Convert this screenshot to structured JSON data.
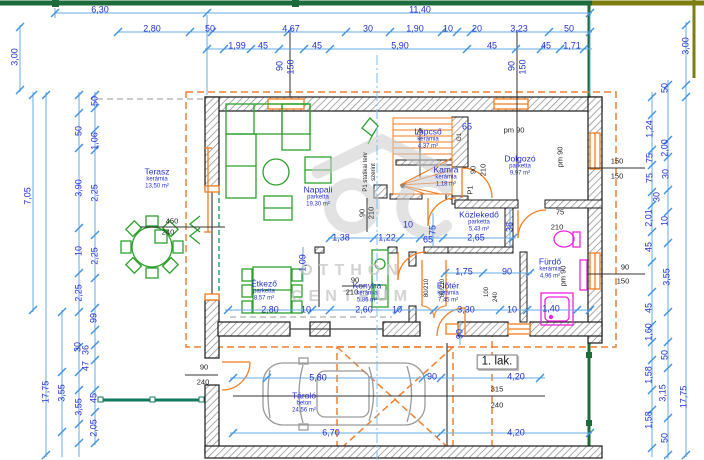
{
  "watermark": {
    "line1": "OTTHON",
    "line2": "CENTRUM"
  },
  "colors": {
    "dimension_blue": "#2531cf",
    "dim_line_blue": "#66abe9",
    "wall_black": "#1a1a1a",
    "door_orange": "#f07d21",
    "furniture_green": "#2ca02c",
    "fixture_magenta": "#ee22dd",
    "boundary_green": "#1c6b3a",
    "boundary_olive": "#7e7e10",
    "fence_teal": "#11795e",
    "watermark_gray": "#c7c7c7",
    "car_gray": "#9a9a9a"
  },
  "plan": {
    "unit_label": "1. lak.",
    "rooms": [
      {
        "name": "Terasz",
        "material": "kerámia",
        "area": "13,50 m²",
        "x": 157,
        "y": 179
      },
      {
        "name": "Nappali",
        "material": "parketta",
        "area": "19,30 m²",
        "x": 318,
        "y": 197
      },
      {
        "name": "Lépcső",
        "material": "kerámia",
        "area": "4,37 m²",
        "x": 428,
        "y": 139
      },
      {
        "name": "Kamra",
        "material": "kerámia",
        "area": "1,18 m²",
        "x": 446,
        "y": 177
      },
      {
        "name": "Dolgozó",
        "material": "parketta",
        "area": "9,97 m²",
        "x": 520,
        "y": 166
      },
      {
        "name": "Közlekedő",
        "material": "parketta",
        "area": "5,43 m²",
        "x": 479,
        "y": 222
      },
      {
        "name": "Fürdő",
        "material": "kerámia",
        "area": "4,96 m²",
        "x": 550,
        "y": 269
      },
      {
        "name": "Előtér",
        "material": "kerámia",
        "area": "7,45 m²",
        "x": 448,
        "y": 293
      },
      {
        "name": "Konyha",
        "material": "kerámia",
        "area": "5,86 m²",
        "x": 367,
        "y": 293
      },
      {
        "name": "Étkező",
        "material": "parketta",
        "area": "8,57 m²",
        "x": 264,
        "y": 291
      },
      {
        "name": "Tároló",
        "material": "beton",
        "area": "24,56 m²",
        "x": 304,
        "y": 403
      }
    ],
    "labels": [
      {
        "t": "6,30",
        "x": 100,
        "y": 10
      },
      {
        "t": "11,40",
        "x": 420,
        "y": 10
      },
      {
        "t": "2,80",
        "x": 152,
        "y": 29
      },
      {
        "t": "50",
        "x": 210,
        "y": 29
      },
      {
        "t": "4,67",
        "x": 291,
        "y": 29
      },
      {
        "t": "30",
        "x": 368,
        "y": 29
      },
      {
        "t": "1,90",
        "x": 415,
        "y": 29
      },
      {
        "t": "10",
        "x": 448,
        "y": 29
      },
      {
        "t": "20",
        "x": 477,
        "y": 29
      },
      {
        "t": "3,23",
        "x": 519,
        "y": 29
      },
      {
        "t": "50",
        "x": 569,
        "y": 29
      },
      {
        "t": "1,99",
        "x": 237,
        "y": 46
      },
      {
        "t": "45",
        "x": 263,
        "y": 46
      },
      {
        "t": "45",
        "x": 317,
        "y": 46
      },
      {
        "t": "5,90",
        "x": 400,
        "y": 46
      },
      {
        "t": "45",
        "x": 492,
        "y": 46
      },
      {
        "t": "45",
        "x": 546,
        "y": 46
      },
      {
        "t": "1,71",
        "x": 572,
        "y": 46
      },
      {
        "t": "90",
        "x": 280,
        "y": 66,
        "r": 1
      },
      {
        "t": "150",
        "x": 291,
        "y": 67,
        "r": 1
      },
      {
        "t": "90",
        "x": 512,
        "y": 66,
        "r": 1
      },
      {
        "t": "150",
        "x": 523,
        "y": 67,
        "r": 1
      },
      {
        "t": "3,00",
        "x": 15,
        "y": 57,
        "r": 1
      },
      {
        "t": "7,05",
        "x": 28,
        "y": 196,
        "r": 1
      },
      {
        "t": "17,75",
        "x": 46,
        "y": 392,
        "r": 1
      },
      {
        "t": "50",
        "x": 95,
        "y": 101,
        "r": 1
      },
      {
        "t": "50",
        "x": 79,
        "y": 131,
        "r": 1
      },
      {
        "t": "1,06",
        "x": 95,
        "y": 141,
        "r": 1
      },
      {
        "t": "3,90",
        "x": 79,
        "y": 188,
        "r": 1
      },
      {
        "t": "2,25",
        "x": 95,
        "y": 193,
        "r": 1
      },
      {
        "t": "10",
        "x": 79,
        "y": 251,
        "r": 1
      },
      {
        "t": "2,25",
        "x": 95,
        "y": 256,
        "r": 1
      },
      {
        "t": "2,25",
        "x": 79,
        "y": 293,
        "r": 1
      },
      {
        "t": "99",
        "x": 94,
        "y": 318,
        "r": 1
      },
      {
        "t": "30",
        "x": 78,
        "y": 347,
        "r": 1
      },
      {
        "t": "36",
        "x": 86,
        "y": 350,
        "r": 1
      },
      {
        "t": "47",
        "x": 86,
        "y": 366,
        "r": 1
      },
      {
        "t": "45",
        "x": 94,
        "y": 398,
        "r": 1
      },
      {
        "t": "3,55",
        "x": 62,
        "y": 393,
        "r": 1
      },
      {
        "t": "3,55",
        "x": 79,
        "y": 407,
        "r": 1
      },
      {
        "t": "2,05",
        "x": 94,
        "y": 428,
        "r": 1
      },
      {
        "t": "3,00",
        "x": 686,
        "y": 46,
        "r": 1
      },
      {
        "t": "17,75",
        "x": 684,
        "y": 397,
        "r": 1
      },
      {
        "t": "50",
        "x": 665,
        "y": 88,
        "r": 1
      },
      {
        "t": "1,24",
        "x": 650,
        "y": 129,
        "r": 1
      },
      {
        "t": "2,00",
        "x": 665,
        "y": 148,
        "r": 1
      },
      {
        "t": "75",
        "x": 650,
        "y": 158,
        "r": 1
      },
      {
        "t": "30",
        "x": 666,
        "y": 174,
        "r": 1
      },
      {
        "t": "75",
        "x": 650,
        "y": 178,
        "r": 1
      },
      {
        "t": "30",
        "x": 657,
        "y": 197,
        "r": 1
      },
      {
        "t": "2,01",
        "x": 649,
        "y": 218,
        "r": 1
      },
      {
        "t": "10",
        "x": 665,
        "y": 221,
        "r": 1
      },
      {
        "t": "45",
        "x": 649,
        "y": 247,
        "r": 1
      },
      {
        "t": "3,55",
        "x": 667,
        "y": 277,
        "r": 1
      },
      {
        "t": "45",
        "x": 649,
        "y": 308,
        "r": 1
      },
      {
        "t": "1,60",
        "x": 649,
        "y": 332,
        "r": 1
      },
      {
        "t": "50",
        "x": 665,
        "y": 355,
        "r": 1
      },
      {
        "t": "1,58",
        "x": 649,
        "y": 375,
        "r": 1
      },
      {
        "t": "3,15",
        "x": 663,
        "y": 393,
        "r": 1
      },
      {
        "t": "1,58",
        "x": 649,
        "y": 420,
        "r": 1
      },
      {
        "t": "50",
        "x": 665,
        "y": 438,
        "r": 1
      },
      {
        "t": "65",
        "x": 467,
        "y": 127
      },
      {
        "t": "1,38",
        "x": 341,
        "y": 238
      },
      {
        "t": "1,22",
        "x": 387,
        "y": 238
      },
      {
        "t": "10",
        "x": 408,
        "y": 225
      },
      {
        "t": "65",
        "x": 428,
        "y": 240
      },
      {
        "t": "2,65",
        "x": 476,
        "y": 238
      },
      {
        "t": "1,75",
        "x": 464,
        "y": 272
      },
      {
        "t": "90",
        "x": 507,
        "y": 272
      },
      {
        "t": "2,80",
        "x": 270,
        "y": 310
      },
      {
        "t": "10",
        "x": 306,
        "y": 310
      },
      {
        "t": "2,60",
        "x": 364,
        "y": 310
      },
      {
        "t": "10",
        "x": 397,
        "y": 310
      },
      {
        "t": "3,30",
        "x": 466,
        "y": 310
      },
      {
        "t": "10",
        "x": 512,
        "y": 310
      },
      {
        "t": "1,40",
        "x": 551,
        "y": 309
      },
      {
        "t": "5,80",
        "x": 318,
        "y": 378
      },
      {
        "t": "90",
        "x": 432,
        "y": 377
      },
      {
        "t": "4,20",
        "x": 516,
        "y": 377
      },
      {
        "t": "6,70",
        "x": 331,
        "y": 433
      },
      {
        "t": "4,20",
        "x": 516,
        "y": 433
      },
      {
        "t": "1,09",
        "x": 303,
        "y": 263,
        "r": 1
      },
      {
        "t": "38",
        "x": 510,
        "y": 227,
        "r": 1
      },
      {
        "t": "75",
        "x": 433,
        "y": 230,
        "r": 1
      },
      {
        "t": "90",
        "x": 460,
        "y": 334,
        "r": 1
      },
      {
        "t": "pm 90",
        "x": 514,
        "y": 130,
        "c": "k"
      },
      {
        "t": "pm 90",
        "x": 560,
        "y": 157,
        "r": 1,
        "c": "k"
      },
      {
        "t": "pm 90",
        "x": 563,
        "y": 276,
        "r": 1,
        "c": "k"
      },
      {
        "t": "150",
        "x": 617,
        "y": 161,
        "c": "k"
      },
      {
        "t": "150",
        "x": 617,
        "y": 176,
        "c": "k"
      },
      {
        "t": "90",
        "x": 355,
        "y": 280,
        "c": "k"
      },
      {
        "t": "210",
        "x": 352,
        "y": 292,
        "c": "k"
      },
      {
        "t": "90",
        "x": 362,
        "y": 213,
        "r": 1,
        "c": "k"
      },
      {
        "t": "210",
        "x": 371,
        "y": 213,
        "r": 1,
        "c": "k"
      },
      {
        "t": "90",
        "x": 473,
        "y": 170,
        "r": 1,
        "c": "k"
      },
      {
        "t": "210",
        "x": 483,
        "y": 170,
        "r": 1,
        "c": "k"
      },
      {
        "t": "P1",
        "x": 470,
        "y": 190,
        "r": 1,
        "c": "k"
      },
      {
        "t": "G1",
        "x": 460,
        "y": 137,
        "r": 1,
        "c": "k",
        "s": 1
      },
      {
        "t": "75",
        "x": 560,
        "y": 212,
        "c": "k"
      },
      {
        "t": "210",
        "x": 557,
        "y": 227,
        "c": "k"
      },
      {
        "t": "90",
        "x": 625,
        "y": 267,
        "c": "k"
      },
      {
        "t": "150",
        "x": 623,
        "y": 281,
        "c": "k"
      },
      {
        "t": "80/210",
        "x": 427,
        "y": 288,
        "r": 1,
        "c": "k",
        "s": 1
      },
      {
        "t": "80/210",
        "x": 443,
        "y": 288,
        "r": 1,
        "c": "k",
        "s": 1
      },
      {
        "t": "100",
        "x": 487,
        "y": 292,
        "r": 1,
        "c": "k",
        "s": 1
      },
      {
        "t": "240",
        "x": 496,
        "y": 297,
        "r": 1,
        "c": "k",
        "s": 1
      },
      {
        "t": "90",
        "x": 204,
        "y": 367,
        "c": "k"
      },
      {
        "t": "240",
        "x": 203,
        "y": 382,
        "c": "k"
      },
      {
        "t": "315",
        "x": 497,
        "y": 389,
        "c": "k"
      },
      {
        "t": "240",
        "x": 497,
        "y": 405,
        "c": "k"
      },
      {
        "t": "450",
        "x": 172,
        "y": 221,
        "c": "k"
      },
      {
        "t": "240",
        "x": 168,
        "y": 232,
        "c": "k"
      },
      {
        "t": "P1 statikai terv",
        "x": 366,
        "y": 172,
        "r": 1,
        "c": "k",
        "s": 1
      },
      {
        "t": "szerint",
        "x": 374,
        "y": 172,
        "r": 1,
        "c": "k",
        "s": 1
      }
    ]
  }
}
